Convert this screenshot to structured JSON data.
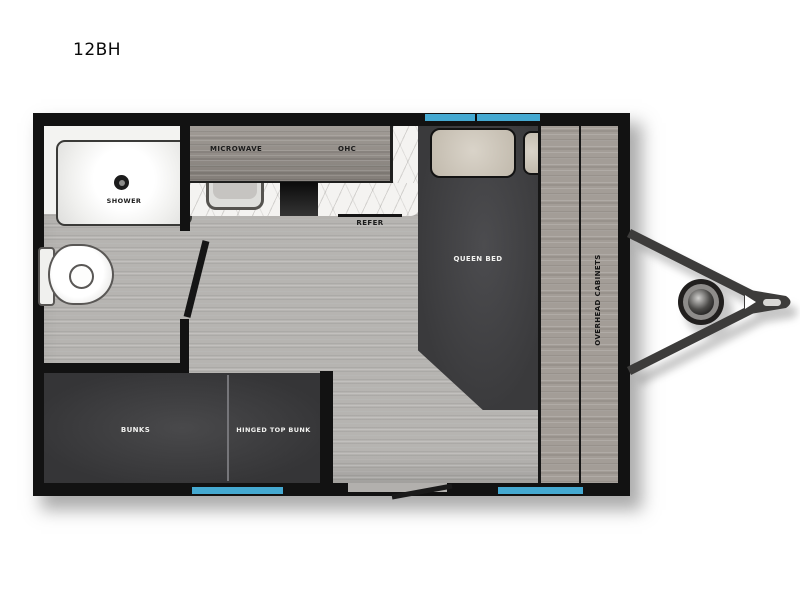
{
  "page": {
    "title": "12BH"
  },
  "floorplan": {
    "labels": {
      "shower": "SHOWER",
      "microwave": "MICROWAVE",
      "ohc": "OHC",
      "refer": "REFER",
      "queen_bed": "QUEEN BED",
      "overhead_cabinets": "OVERHEAD CABINETS",
      "bunks": "BUNKS",
      "hinged_top_bunk": "HINGED TOP BUNK"
    },
    "colors": {
      "wall": "#121212",
      "window": "#45a9d1",
      "floor": "#b6b4b1",
      "cabinet_wood": "#958f89",
      "overhead_cabinet_wood": "#a39d97",
      "countertop": "#f4f3f1",
      "furniture_dark": "#3c3c3e",
      "pillow": "#cdc5b7"
    }
  }
}
